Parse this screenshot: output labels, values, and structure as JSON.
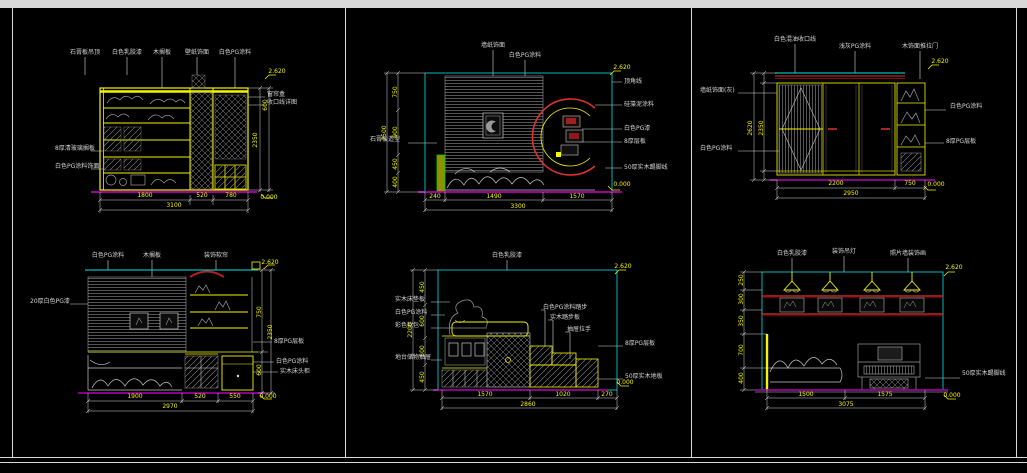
{
  "canvas": {
    "background": "#000000",
    "frame_color": "#d8d8d8",
    "accent_colors": {
      "linework_yellow": "#f5f500",
      "viewport_cyan": "#00e8e8",
      "floor_magenta": "#b400b4",
      "trim_red": "#e03030",
      "trim_dark_red": "#7c1010",
      "sketch_gray": "#9a9a9a",
      "column_green": "#00d000"
    }
  },
  "drawings": [
    {
      "name": "elevation-bookshelf-wall",
      "texts": [
        {
          "t": "石膏板吊顶",
          "x": 30,
          "y": 8,
          "k": "lbl"
        },
        {
          "t": "白色乳胶漆",
          "x": 72,
          "y": 8,
          "k": "lbl"
        },
        {
          "t": "木搁板",
          "x": 107,
          "y": 8,
          "k": "lbl"
        },
        {
          "t": "壁纸饰面",
          "x": 142,
          "y": 8,
          "k": "lbl"
        },
        {
          "t": "白色PG涂料",
          "x": 180,
          "y": 8,
          "k": "lbl"
        },
        {
          "t": "8厚清玻璃搁板",
          "x": 0,
          "y": 104,
          "k": "lbl",
          "a": "l"
        },
        {
          "t": "白色PG涂料饰面",
          "x": 0,
          "y": 122,
          "k": "lbl",
          "a": "l"
        },
        {
          "t": "窗帘盒",
          "x": 212,
          "y": 50,
          "k": "lbl",
          "a": "l"
        },
        {
          "t": "收口线详图",
          "x": 212,
          "y": 58,
          "k": "lbl",
          "a": "l"
        },
        {
          "t": "1800",
          "x": 90,
          "y": 151,
          "k": "dim"
        },
        {
          "t": "520",
          "x": 147,
          "y": 151,
          "k": "dim"
        },
        {
          "t": "780",
          "x": 176,
          "y": 151,
          "k": "dim"
        },
        {
          "t": "3100",
          "x": 119,
          "y": 161,
          "k": "dim"
        },
        {
          "t": "2350",
          "x": 201,
          "y": 95,
          "k": "dim",
          "r": -90
        },
        {
          "t": "600",
          "x": 211,
          "y": 60,
          "k": "dim",
          "r": -90
        },
        {
          "t": "2.620",
          "x": 222,
          "y": 27,
          "k": "lvl"
        },
        {
          "t": "0.000",
          "x": 214,
          "y": 153,
          "k": "lvl"
        }
      ]
    },
    {
      "name": "elevation-bed-headboard-moon",
      "texts": [
        {
          "t": "墙纸饰面",
          "x": 123,
          "y": 6,
          "k": "lbl"
        },
        {
          "t": "白色PG涂料",
          "x": 155,
          "y": 16,
          "k": "lbl"
        },
        {
          "t": "石膏板造型",
          "x": 0,
          "y": 100,
          "k": "lbl",
          "a": "l"
        },
        {
          "t": "顶角线",
          "x": 254,
          "y": 42,
          "k": "lbl",
          "a": "l"
        },
        {
          "t": "硅藻泥涂料",
          "x": 254,
          "y": 65,
          "k": "lbl",
          "a": "l"
        },
        {
          "t": "白色PG漆",
          "x": 254,
          "y": 89,
          "k": "lbl",
          "a": "l"
        },
        {
          "t": "8厚层板",
          "x": 254,
          "y": 102,
          "k": "lbl",
          "a": "l"
        },
        {
          "t": "50厚实木踢脚线",
          "x": 254,
          "y": 128,
          "k": "lbl",
          "a": "l"
        },
        {
          "t": "750",
          "x": 26,
          "y": 52,
          "k": "dim",
          "r": -90
        },
        {
          "t": "900",
          "x": 26,
          "y": 92,
          "k": "dim",
          "r": -90
        },
        {
          "t": "450",
          "x": 26,
          "y": 124,
          "k": "dim",
          "r": -90
        },
        {
          "t": "400",
          "x": 26,
          "y": 142,
          "k": "dim",
          "r": -90
        },
        {
          "t": "2500",
          "x": 15,
          "y": 93,
          "k": "dim",
          "r": -90
        },
        {
          "t": "240",
          "x": 65,
          "y": 157,
          "k": "dim"
        },
        {
          "t": "1490",
          "x": 124,
          "y": 157,
          "k": "dim"
        },
        {
          "t": "1570",
          "x": 207,
          "y": 157,
          "k": "dim"
        },
        {
          "t": "3300",
          "x": 148,
          "y": 167,
          "k": "dim"
        },
        {
          "t": "2.620",
          "x": 252,
          "y": 28,
          "k": "lvl"
        },
        {
          "t": "0.000",
          "x": 252,
          "y": 145,
          "k": "lvl"
        }
      ]
    },
    {
      "name": "elevation-wardrobe",
      "texts": [
        {
          "t": "白色混油收口线",
          "x": 95,
          "y": 5,
          "k": "lbl"
        },
        {
          "t": "浅灰PG涂料",
          "x": 155,
          "y": 12,
          "k": "lbl"
        },
        {
          "t": "木饰面推拉门",
          "x": 220,
          "y": 12,
          "k": "lbl"
        },
        {
          "t": "墙纸饰面(灰)",
          "x": 0,
          "y": 56,
          "k": "lbl",
          "a": "l"
        },
        {
          "t": "白色PG涂料",
          "x": 0,
          "y": 114,
          "k": "lbl",
          "a": "l"
        },
        {
          "t": "白色PG涂料",
          "x": 250,
          "y": 72,
          "k": "lbl",
          "a": "l"
        },
        {
          "t": "8厚PG层板",
          "x": 246,
          "y": 107,
          "k": "lbl",
          "a": "l"
        },
        {
          "t": "2350",
          "x": 62,
          "y": 93,
          "k": "dim",
          "r": -90
        },
        {
          "t": "2620",
          "x": 51,
          "y": 93,
          "k": "dim",
          "r": -90
        },
        {
          "t": "2200",
          "x": 136,
          "y": 149,
          "k": "dim"
        },
        {
          "t": "750",
          "x": 210,
          "y": 149,
          "k": "dim"
        },
        {
          "t": "2950",
          "x": 151,
          "y": 159,
          "k": "dim"
        },
        {
          "t": "2.620",
          "x": 240,
          "y": 27,
          "k": "lvl"
        },
        {
          "t": "0.000",
          "x": 236,
          "y": 150,
          "k": "lvl"
        }
      ]
    },
    {
      "name": "elevation-bed-wall-frames",
      "texts": [
        {
          "t": "白色PG涂料",
          "x": 78,
          "y": 6,
          "k": "lbl"
        },
        {
          "t": "木搁板",
          "x": 122,
          "y": 6,
          "k": "lbl"
        },
        {
          "t": "装饰软帘",
          "x": 186,
          "y": 6,
          "k": "lbl"
        },
        {
          "t": "20厚白色PG漆",
          "x": 0,
          "y": 52,
          "k": "lbl",
          "a": "l"
        },
        {
          "t": "8厚PG层板",
          "x": 244,
          "y": 92,
          "k": "lbl",
          "a": "l"
        },
        {
          "t": "白色PG涂料",
          "x": 246,
          "y": 112,
          "k": "lbl",
          "a": "l"
        },
        {
          "t": "实木床头柜",
          "x": 250,
          "y": 122,
          "k": "lbl",
          "a": "l"
        },
        {
          "t": "750",
          "x": 230,
          "y": 62,
          "k": "dim",
          "r": -90
        },
        {
          "t": "600",
          "x": 230,
          "y": 120,
          "k": "dim",
          "r": -90
        },
        {
          "t": "2350",
          "x": 241,
          "y": 82,
          "k": "dim",
          "r": -90
        },
        {
          "t": "1900",
          "x": 105,
          "y": 147,
          "k": "dim"
        },
        {
          "t": "520",
          "x": 170,
          "y": 147,
          "k": "dim"
        },
        {
          "t": "550",
          "x": 205,
          "y": 147,
          "k": "dim"
        },
        {
          "t": "2970",
          "x": 140,
          "y": 157,
          "k": "dim"
        },
        {
          "t": "2.620",
          "x": 240,
          "y": 13,
          "k": "lvl"
        },
        {
          "t": "0.000",
          "x": 238,
          "y": 147,
          "k": "lvl"
        }
      ]
    },
    {
      "name": "elevation-tatami-step-bed",
      "texts": [
        {
          "t": "白色乳胶漆",
          "x": 112,
          "y": 6,
          "k": "lbl"
        },
        {
          "t": "实木床垫板",
          "x": 0,
          "y": 50,
          "k": "lbl",
          "a": "l"
        },
        {
          "t": "白色PG涂料",
          "x": 0,
          "y": 63,
          "k": "lbl",
          "a": "l"
        },
        {
          "t": "彩色软包",
          "x": 0,
          "y": 76,
          "k": "lbl",
          "a": "l"
        },
        {
          "t": "地台储物抽屉",
          "x": 0,
          "y": 108,
          "k": "lbl",
          "a": "l"
        },
        {
          "t": "白色PG涂料踏步",
          "x": 148,
          "y": 58,
          "k": "lbl",
          "a": "l"
        },
        {
          "t": "实木踏步板",
          "x": 155,
          "y": 68,
          "k": "lbl",
          "a": "l"
        },
        {
          "t": "抽屉拉手",
          "x": 172,
          "y": 80,
          "k": "lbl",
          "a": "l"
        },
        {
          "t": "8厚PG层板",
          "x": 230,
          "y": 94,
          "k": "lbl",
          "a": "l"
        },
        {
          "t": "50厚实木地板",
          "x": 230,
          "y": 127,
          "k": "lbl",
          "a": "l"
        },
        {
          "t": "450",
          "x": 28,
          "y": 37,
          "k": "dim",
          "r": -90
        },
        {
          "t": "600",
          "x": 28,
          "y": 71,
          "k": "dim",
          "r": -90
        },
        {
          "t": "500",
          "x": 28,
          "y": 101,
          "k": "dim",
          "r": -90
        },
        {
          "t": "450",
          "x": 28,
          "y": 127,
          "k": "dim",
          "r": -90
        },
        {
          "t": "2200",
          "x": 16,
          "y": 80,
          "k": "dim",
          "r": -90
        },
        {
          "t": "1570",
          "x": 90,
          "y": 145,
          "k": "dim"
        },
        {
          "t": "1020",
          "x": 168,
          "y": 145,
          "k": "dim"
        },
        {
          "t": "270",
          "x": 212,
          "y": 145,
          "k": "dim"
        },
        {
          "t": "2860",
          "x": 133,
          "y": 155,
          "k": "dim"
        },
        {
          "t": "2.620",
          "x": 228,
          "y": 17,
          "k": "lvl"
        },
        {
          "t": "0.000",
          "x": 230,
          "y": 133,
          "k": "lvl"
        }
      ]
    },
    {
      "name": "elevation-piano-wall",
      "texts": [
        {
          "t": "白色乳胶漆",
          "x": 62,
          "y": 4,
          "k": "lbl"
        },
        {
          "t": "装饰吊灯",
          "x": 114,
          "y": 2,
          "k": "lbl"
        },
        {
          "t": "照片墙装饰画",
          "x": 178,
          "y": 4,
          "k": "lbl"
        },
        {
          "t": "50厚实木踢脚线",
          "x": 232,
          "y": 124,
          "k": "lbl",
          "a": "l"
        },
        {
          "t": "250",
          "x": 12,
          "y": 30,
          "k": "dim",
          "r": -90
        },
        {
          "t": "300",
          "x": 12,
          "y": 49,
          "k": "dim",
          "r": -90
        },
        {
          "t": "350",
          "x": 12,
          "y": 71,
          "k": "dim",
          "r": -90
        },
        {
          "t": "700",
          "x": 12,
          "y": 100,
          "k": "dim",
          "r": -90
        },
        {
          "t": "400",
          "x": 12,
          "y": 128,
          "k": "dim",
          "r": -90
        },
        {
          "t": "1500",
          "x": 76,
          "y": 145,
          "k": "dim"
        },
        {
          "t": "1575",
          "x": 155,
          "y": 145,
          "k": "dim"
        },
        {
          "t": "3075",
          "x": 116,
          "y": 155,
          "k": "dim"
        },
        {
          "t": "2.620",
          "x": 224,
          "y": 18,
          "k": "lvl"
        },
        {
          "t": "0.000",
          "x": 222,
          "y": 146,
          "k": "lvl"
        }
      ]
    }
  ]
}
